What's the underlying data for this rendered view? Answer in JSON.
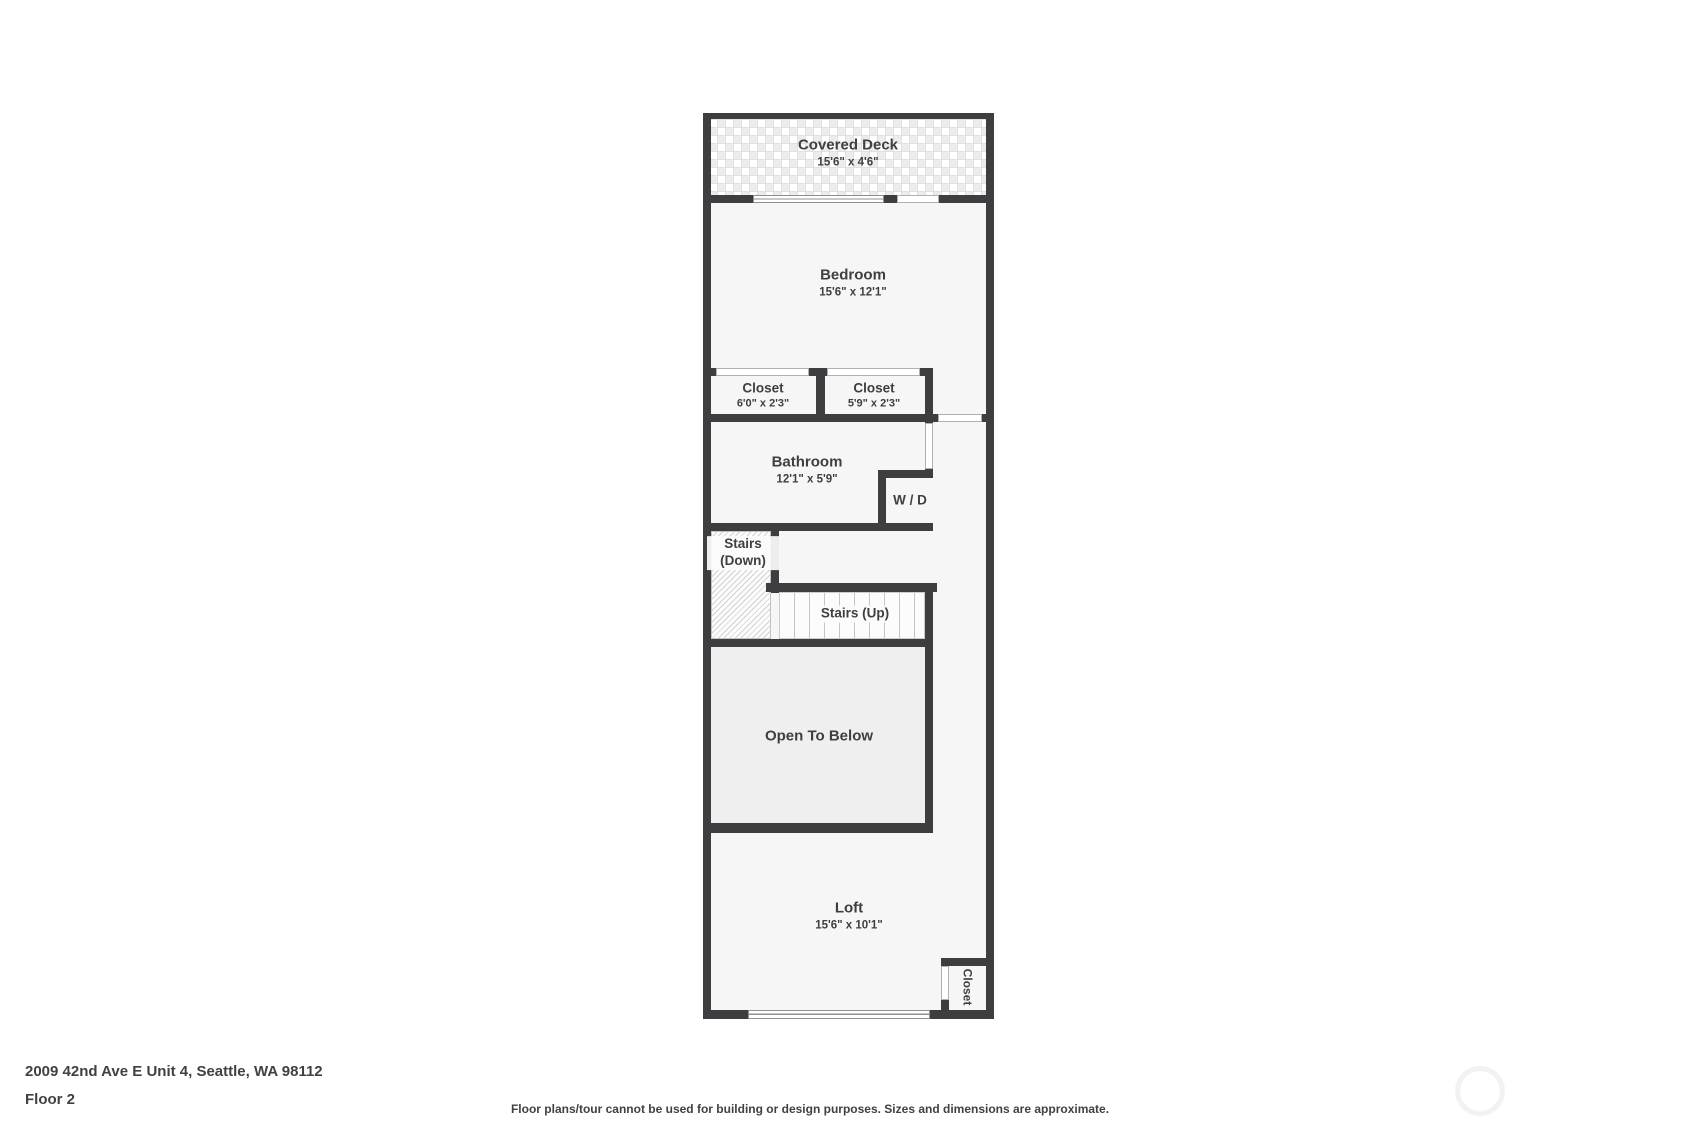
{
  "colors": {
    "wall": "#3e3e40",
    "room_fill": "#f6f6f6",
    "open_to_below_fill": "#efefef",
    "text": "#3f3f41"
  },
  "rooms": {
    "covered_deck": {
      "name": "Covered Deck",
      "dims": "15'6\" x 4'6\""
    },
    "bedroom": {
      "name": "Bedroom",
      "dims": "15'6\" x 12'1\""
    },
    "closet_left": {
      "name": "Closet",
      "dims": "6'0\" x 2'3\""
    },
    "closet_right": {
      "name": "Closet",
      "dims": "5'9\" x 2'3\""
    },
    "bathroom": {
      "name": "Bathroom",
      "dims": "12'1\" x 5'9\""
    },
    "washer_dryer": {
      "name": "W / D"
    },
    "stairs_down": {
      "name": "Stairs (Down)"
    },
    "stairs_up": {
      "name": "Stairs (Up)"
    },
    "open_to_below": {
      "name": "Open To Below"
    },
    "loft": {
      "name": "Loft",
      "dims": "15'6\" x 10'1\""
    },
    "loft_closet": {
      "name": "Closet"
    }
  },
  "footer": {
    "address": "2009 42nd Ave E Unit 4, Seattle, WA 98112",
    "floor_label": "Floor 2",
    "disclaimer": "Floor plans/tour cannot be used for building or design purposes. Sizes and dimensions are approximate."
  }
}
